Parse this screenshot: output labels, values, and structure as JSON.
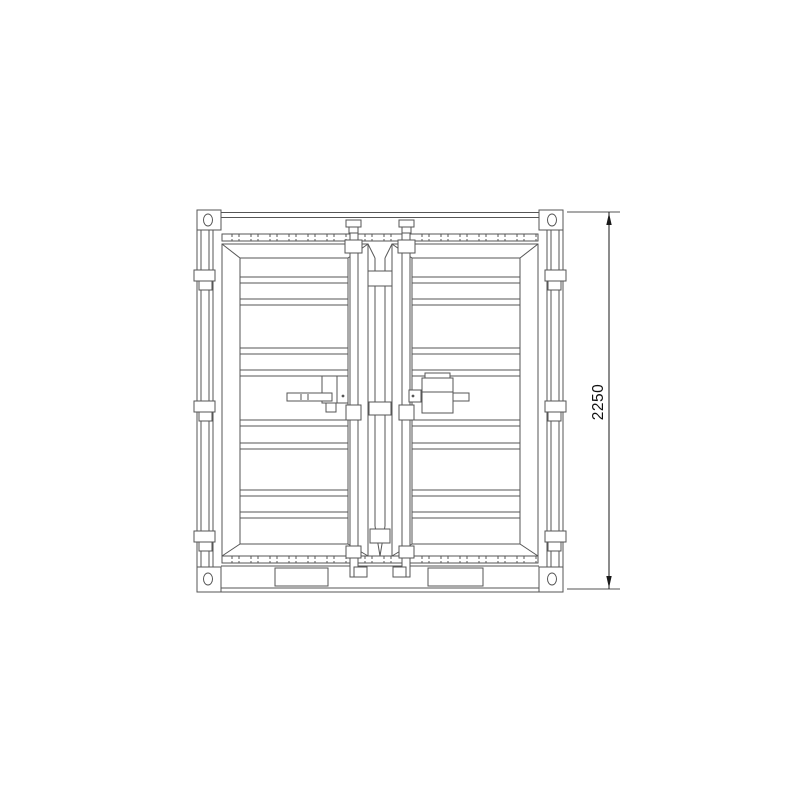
{
  "drawing": {
    "kind": "container-door-end-elevation",
    "background": "#ffffff",
    "line_color": "#565656",
    "dimension_color": "#1a1a1a",
    "dimension": {
      "label": "2250",
      "orientation": "vertical",
      "side": "right"
    }
  }
}
